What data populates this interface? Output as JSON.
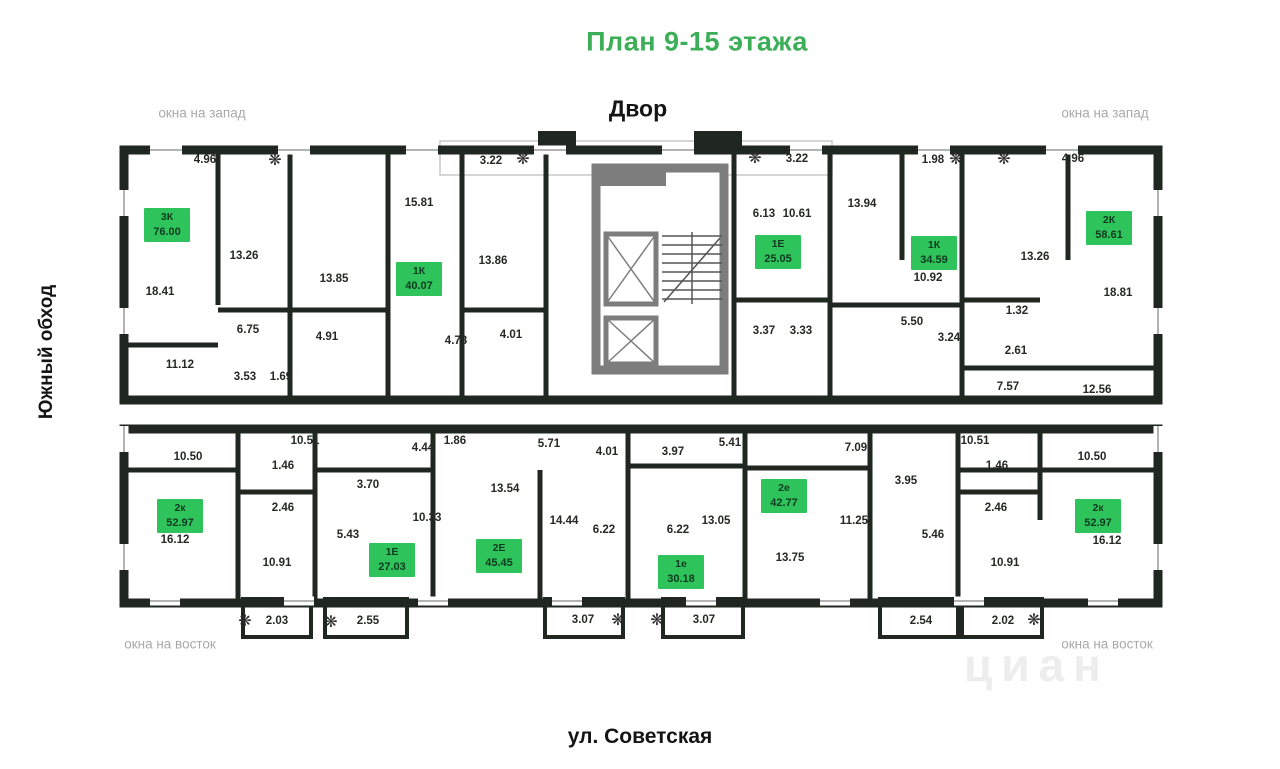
{
  "header": {
    "title": "План 9-15 этажа"
  },
  "surroundings": {
    "courtyard": "Двор",
    "street": "ул. Советская",
    "side_road": "Южный обход",
    "watermark": "циан"
  },
  "colors": {
    "accent_green": "#3cae58",
    "badge_green": "#2fc35c",
    "wall_dark": "#1f2720",
    "core_gray": "#7d7d7d",
    "muted_gray": "#a9a9a9"
  },
  "window_labels": [
    {
      "text": "окна на запад",
      "x": 202,
      "y": 113
    },
    {
      "text": "окна на запад",
      "x": 1105,
      "y": 113
    },
    {
      "text": "окна на восток",
      "x": 170,
      "y": 644
    },
    {
      "text": "окна на восток",
      "x": 1107,
      "y": 644
    }
  ],
  "apartments": [
    {
      "type": "3К",
      "area": "76.00",
      "x": 167,
      "y": 225
    },
    {
      "type": "1К",
      "area": "40.07",
      "x": 419,
      "y": 279
    },
    {
      "type": "1Е",
      "area": "25.05",
      "x": 778,
      "y": 252
    },
    {
      "type": "1К",
      "area": "34.59",
      "x": 934,
      "y": 253
    },
    {
      "type": "2К",
      "area": "58.61",
      "x": 1109,
      "y": 228
    },
    {
      "type": "2к",
      "area": "52.97",
      "x": 180,
      "y": 516
    },
    {
      "type": "1Е",
      "area": "27.03",
      "x": 392,
      "y": 560
    },
    {
      "type": "2Е",
      "area": "45.45",
      "x": 499,
      "y": 556
    },
    {
      "type": "1е",
      "area": "30.18",
      "x": 681,
      "y": 572
    },
    {
      "type": "2е",
      "area": "42.77",
      "x": 784,
      "y": 496
    },
    {
      "type": "2к",
      "area": "52.97",
      "x": 1098,
      "y": 516
    }
  ],
  "rooms": [
    {
      "v": "4.96",
      "x": 205,
      "y": 160
    },
    {
      "v": "3.22",
      "x": 491,
      "y": 161
    },
    {
      "v": "3.22",
      "x": 797,
      "y": 159
    },
    {
      "v": "1.98",
      "x": 933,
      "y": 160
    },
    {
      "v": "4.96",
      "x": 1073,
      "y": 159
    },
    {
      "v": "13.26",
      "x": 244,
      "y": 256
    },
    {
      "v": "18.41",
      "x": 160,
      "y": 292
    },
    {
      "v": "13.85",
      "x": 334,
      "y": 279
    },
    {
      "v": "15.81",
      "x": 419,
      "y": 203
    },
    {
      "v": "13.86",
      "x": 493,
      "y": 261
    },
    {
      "v": "6.75",
      "x": 248,
      "y": 330
    },
    {
      "v": "4.91",
      "x": 327,
      "y": 337
    },
    {
      "v": "4.78",
      "x": 456,
      "y": 341
    },
    {
      "v": "4.01",
      "x": 511,
      "y": 335
    },
    {
      "v": "11.12",
      "x": 180,
      "y": 365
    },
    {
      "v": "3.53",
      "x": 245,
      "y": 377
    },
    {
      "v": "1.69",
      "x": 281,
      "y": 377
    },
    {
      "v": "6.13",
      "x": 764,
      "y": 214
    },
    {
      "v": "10.61",
      "x": 797,
      "y": 214
    },
    {
      "v": "3.37",
      "x": 764,
      "y": 331
    },
    {
      "v": "3.33",
      "x": 801,
      "y": 331
    },
    {
      "v": "13.94",
      "x": 862,
      "y": 204
    },
    {
      "v": "10.92",
      "x": 928,
      "y": 278
    },
    {
      "v": "13.26",
      "x": 1035,
      "y": 257
    },
    {
      "v": "18.81",
      "x": 1118,
      "y": 293
    },
    {
      "v": "5.50",
      "x": 912,
      "y": 322
    },
    {
      "v": "3.24",
      "x": 949,
      "y": 338
    },
    {
      "v": "1.32",
      "x": 1017,
      "y": 311
    },
    {
      "v": "2.61",
      "x": 1016,
      "y": 351
    },
    {
      "v": "7.57",
      "x": 1008,
      "y": 387
    },
    {
      "v": "12.56",
      "x": 1097,
      "y": 390
    },
    {
      "v": "10.50",
      "x": 188,
      "y": 457
    },
    {
      "v": "10.51",
      "x": 305,
      "y": 441
    },
    {
      "v": "1.46",
      "x": 283,
      "y": 466
    },
    {
      "v": "2.46",
      "x": 283,
      "y": 508
    },
    {
      "v": "3.70",
      "x": 368,
      "y": 485
    },
    {
      "v": "4.44",
      "x": 423,
      "y": 448
    },
    {
      "v": "1.86",
      "x": 455,
      "y": 441
    },
    {
      "v": "10.33",
      "x": 427,
      "y": 518
    },
    {
      "v": "16.12",
      "x": 175,
      "y": 540
    },
    {
      "v": "10.91",
      "x": 277,
      "y": 563
    },
    {
      "v": "5.43",
      "x": 348,
      "y": 535
    },
    {
      "v": "2.03",
      "x": 277,
      "y": 621
    },
    {
      "v": "2.55",
      "x": 368,
      "y": 621
    },
    {
      "v": "5.71",
      "x": 549,
      "y": 444
    },
    {
      "v": "4.01",
      "x": 607,
      "y": 452
    },
    {
      "v": "3.97",
      "x": 673,
      "y": 452
    },
    {
      "v": "13.54",
      "x": 505,
      "y": 489
    },
    {
      "v": "14.44",
      "x": 564,
      "y": 521
    },
    {
      "v": "6.22",
      "x": 604,
      "y": 530
    },
    {
      "v": "6.22",
      "x": 678,
      "y": 530
    },
    {
      "v": "13.05",
      "x": 716,
      "y": 521
    },
    {
      "v": "3.07",
      "x": 583,
      "y": 620
    },
    {
      "v": "3.07",
      "x": 704,
      "y": 620
    },
    {
      "v": "5.41",
      "x": 730,
      "y": 443
    },
    {
      "v": "7.09",
      "x": 856,
      "y": 448
    },
    {
      "v": "3.95",
      "x": 906,
      "y": 481
    },
    {
      "v": "11.25",
      "x": 854,
      "y": 521
    },
    {
      "v": "13.75",
      "x": 790,
      "y": 558
    },
    {
      "v": "5.46",
      "x": 933,
      "y": 535
    },
    {
      "v": "2.54",
      "x": 921,
      "y": 621
    },
    {
      "v": "10.51",
      "x": 975,
      "y": 441
    },
    {
      "v": "1.46",
      "x": 997,
      "y": 466
    },
    {
      "v": "2.46",
      "x": 996,
      "y": 508
    },
    {
      "v": "10.50",
      "x": 1092,
      "y": 457
    },
    {
      "v": "16.12",
      "x": 1107,
      "y": 541
    },
    {
      "v": "10.91",
      "x": 1005,
      "y": 563
    },
    {
      "v": "2.02",
      "x": 1003,
      "y": 621
    }
  ],
  "snowflakes": [
    {
      "x": 275,
      "y": 160
    },
    {
      "x": 523,
      "y": 159
    },
    {
      "x": 755,
      "y": 158
    },
    {
      "x": 956,
      "y": 159
    },
    {
      "x": 1004,
      "y": 159
    },
    {
      "x": 245,
      "y": 621
    },
    {
      "x": 331,
      "y": 622
    },
    {
      "x": 618,
      "y": 620
    },
    {
      "x": 657,
      "y": 620
    },
    {
      "x": 1034,
      "y": 620
    }
  ]
}
